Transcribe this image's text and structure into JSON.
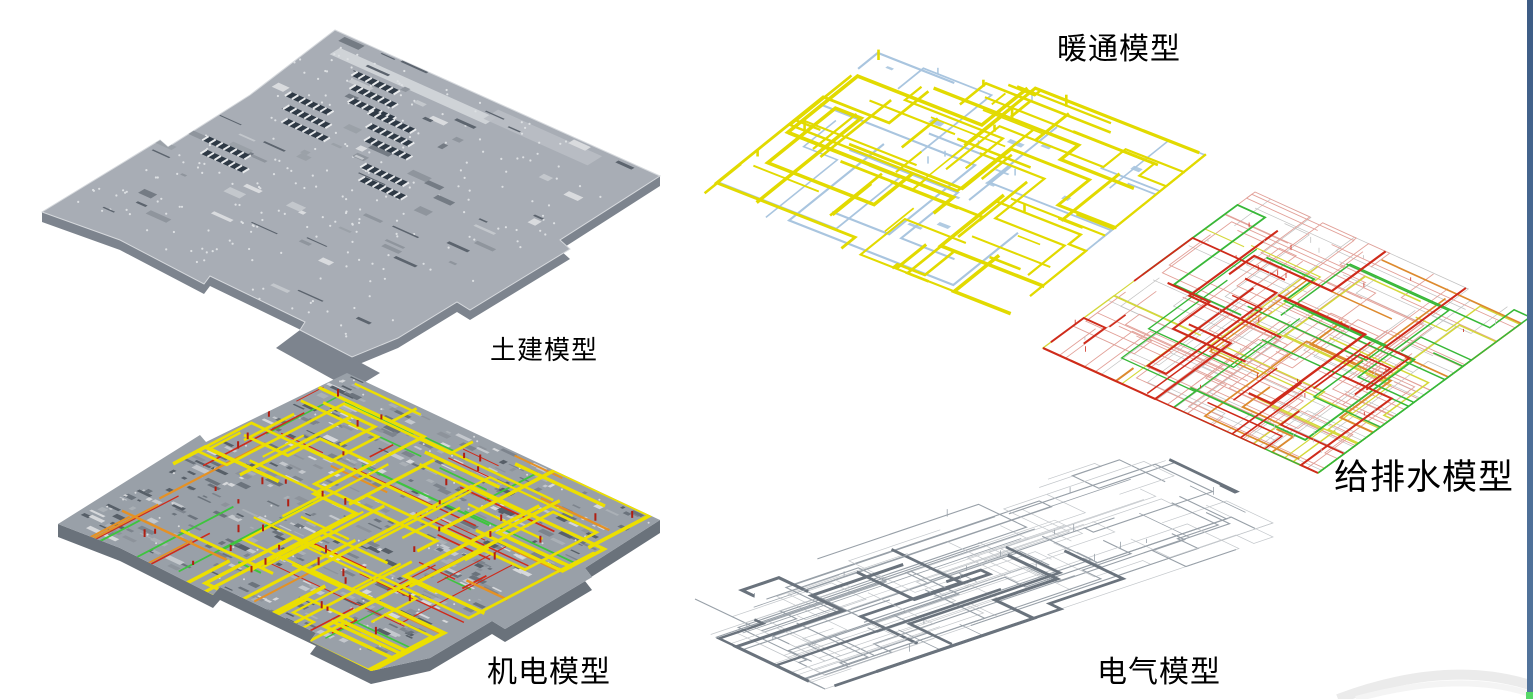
{
  "page": {
    "background": "#ffffff"
  },
  "models": {
    "civil": {
      "label": "土建模型"
    },
    "mep": {
      "label": "机电模型"
    },
    "hvac": {
      "label": "暖通模型"
    },
    "plumbing": {
      "label": "给排水模型"
    },
    "electrical": {
      "label": "电气模型"
    }
  },
  "colors": {
    "civil_base": "#a8adb5",
    "civil_light": "#d6d9dd",
    "civil_dark": "#7d848e",
    "civil_opening": "#2f3a46",
    "civil_dot": "#dde0e3",
    "mep_base": "#99a0a8",
    "mep_dark": "#6a727b",
    "mep_yellow": "#ecdf00",
    "mep_green": "#3ec43e",
    "mep_red": "#cf2a1a",
    "mep_orange": "#e59124",
    "mep_tick_red": "#b01e12",
    "hvac_yellow": "#e2da00",
    "hvac_blue": "#a9c5df",
    "plumb_pink": "#e2a098",
    "plumb_red": "#cf2b1b",
    "plumb_green": "#38b838",
    "plumb_yellow": "#d4d83a",
    "plumb_orange": "#dd8a2e",
    "plumb_gray": "#c2c2c2",
    "elec_light": "#c3c7cb",
    "elec_mid": "#98a0a8",
    "elec_dark": "#6a737d",
    "edge_bar_top": "#3d5c85",
    "edge_bar_bottom": "#52749c",
    "corner_green": "#55d868",
    "swoosh": "#ebebeb"
  }
}
